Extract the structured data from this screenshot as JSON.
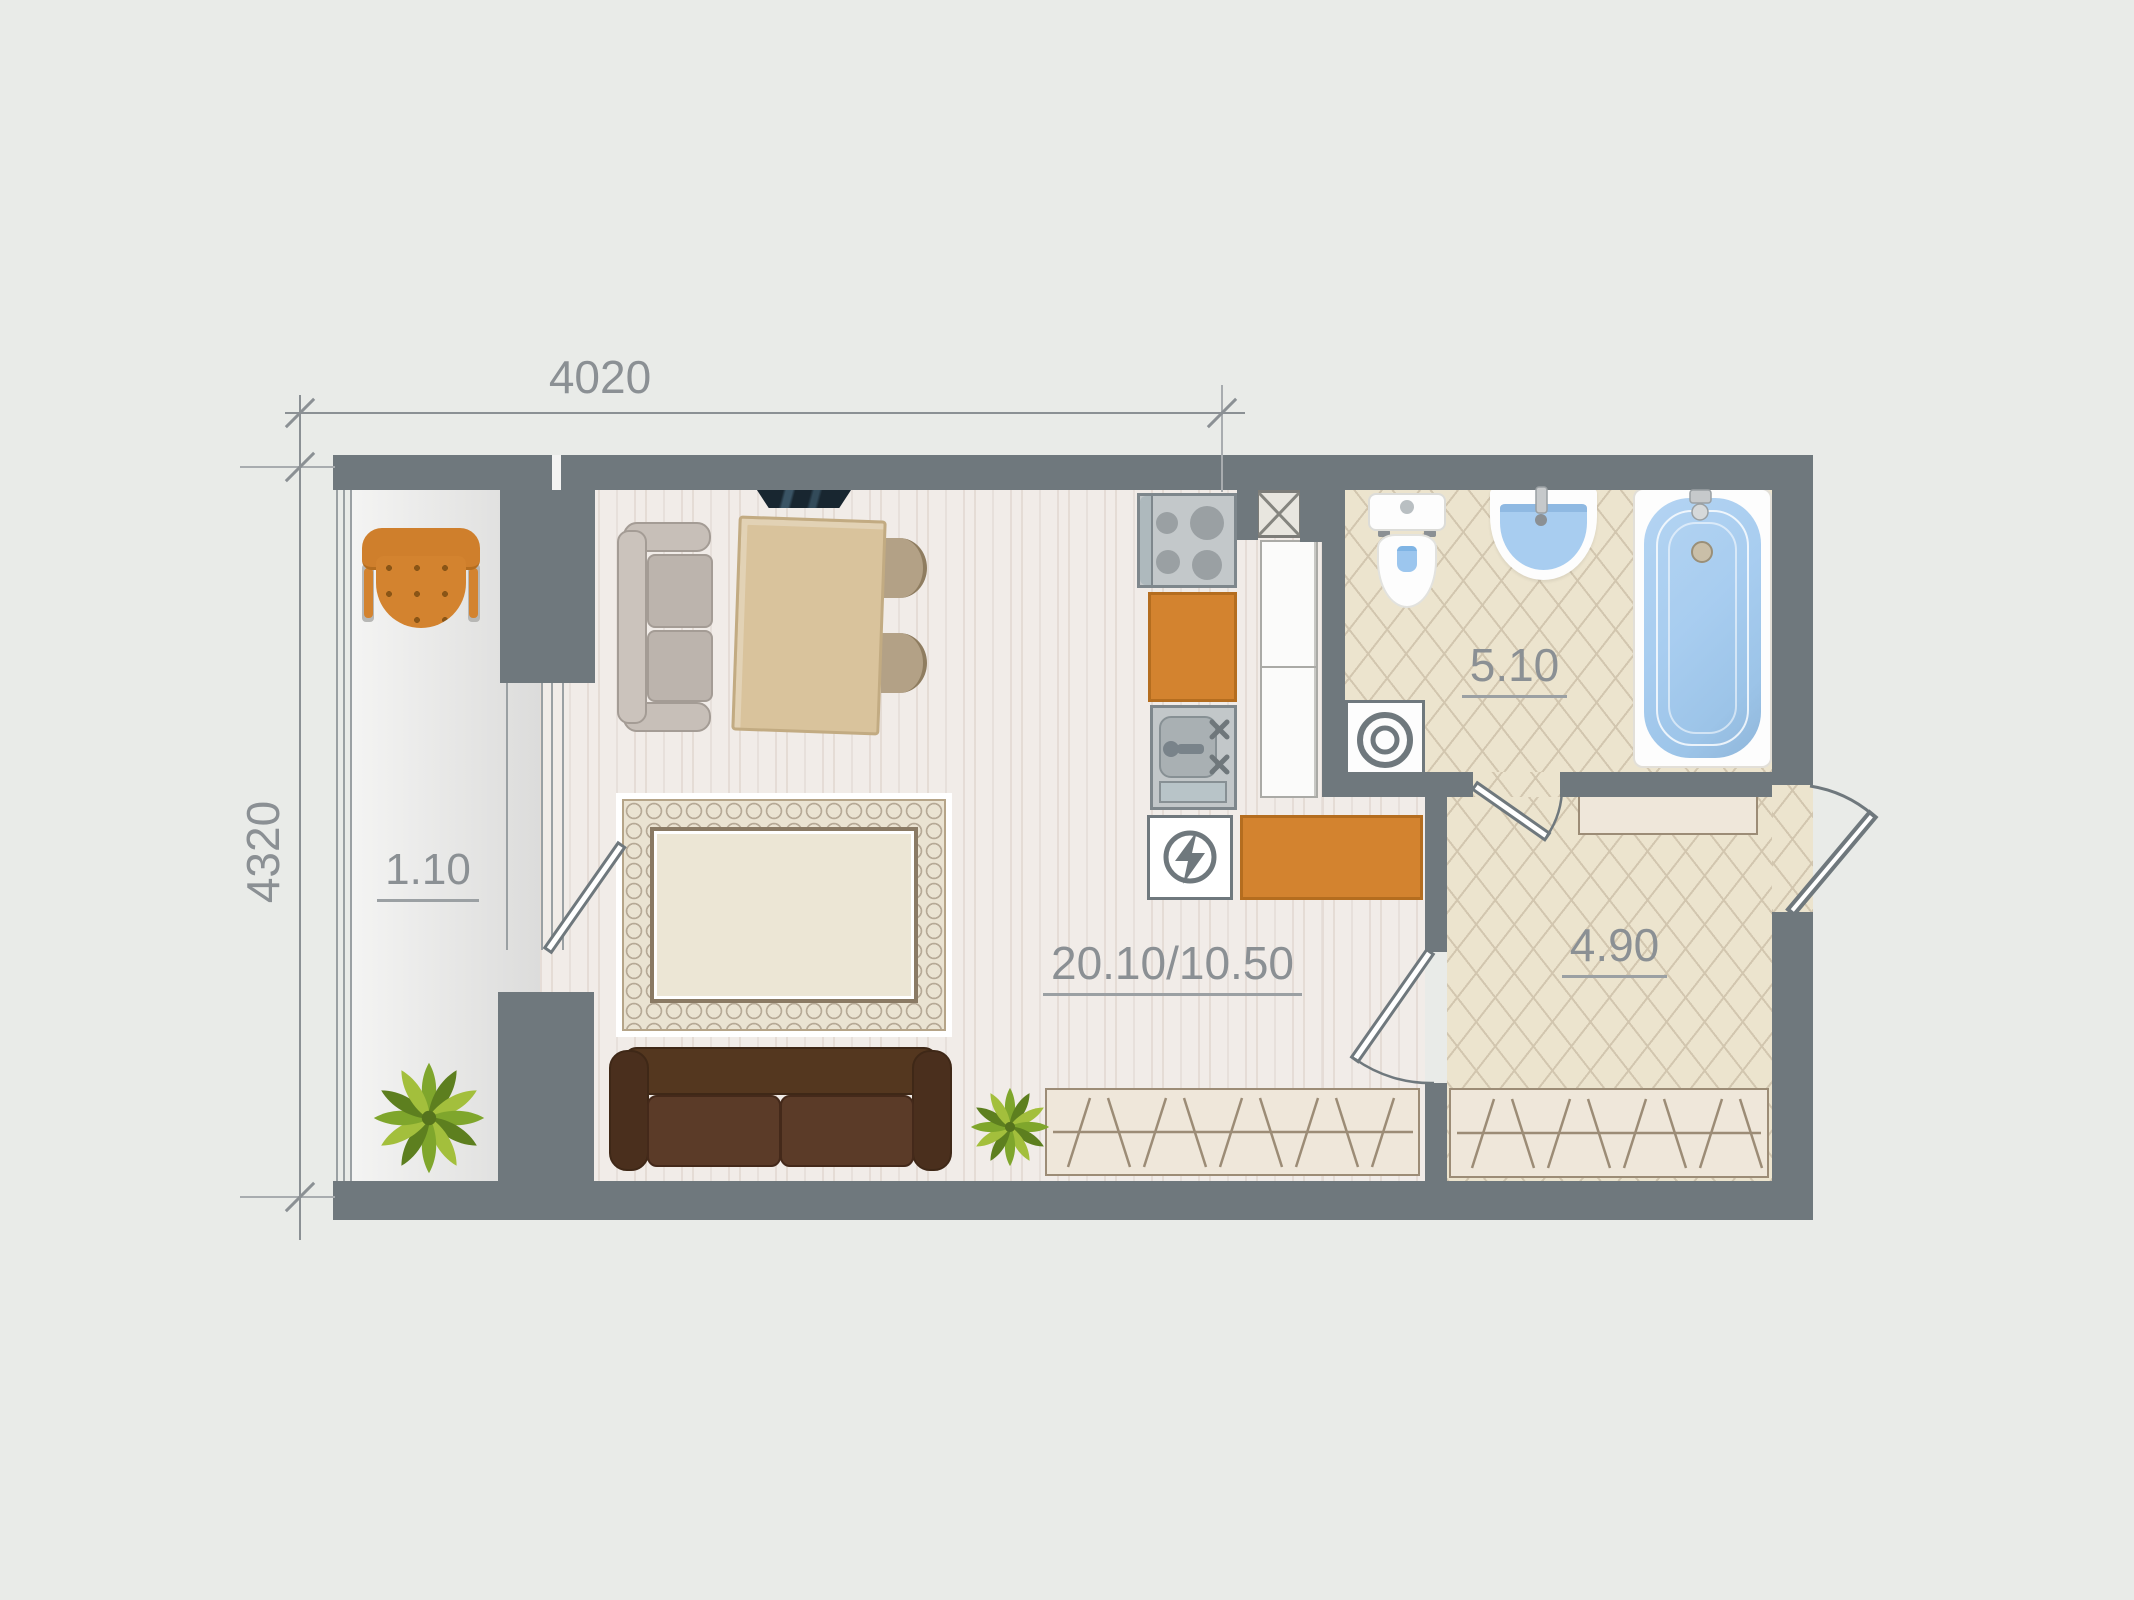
{
  "plan": {
    "dimensions": {
      "top": "4020",
      "left": "4320"
    },
    "rooms": {
      "balcony_area": "1.10",
      "living_area": "20.10/10.50",
      "bathroom_area": "5.10",
      "hallway_area": "4.90"
    },
    "furniture": [
      "armchair",
      "plant",
      "loveseat",
      "tv",
      "dining-table",
      "dining-chair",
      "rug",
      "sofa",
      "wardrobe",
      "stove",
      "kitchen-cabinet",
      "kitchen-sink",
      "electric-panel",
      "kitchen-counter",
      "vent-shaft",
      "tall-cabinet",
      "toilet",
      "washbasin",
      "bathtub",
      "washing-machine",
      "shelf"
    ]
  },
  "colors": {
    "bg": "#e9ebe8",
    "wall": "#6f787d",
    "label": "#8b9094",
    "glass": "#9aa0a3",
    "wood": "#f1ece8",
    "tile": "#ece4ce",
    "tile_line": "#d2c6af",
    "orange": "#d3832f",
    "orange_dark": "#b46d1f",
    "water": "#a8cdf0",
    "white": "#fdfdfd",
    "steel": "#c3c8ca",
    "steel_dark": "#828b90",
    "tv": "#182630",
    "green": "#7fa62c",
    "green_dark": "#5d7f1f",
    "green_light": "#a3bf3c",
    "sofa": "#5b3b28",
    "sofa_dark": "#3f2817",
    "graysofa": "#bcb4ad",
    "graysofa_dark": "#a49c95",
    "table": "#d9c39c",
    "table_border": "#c2ab82",
    "chair": "#b3a186",
    "beige": "#efe7da",
    "beige_border": "#9c8c76",
    "rug_band": "#eae3d2",
    "rug_line": "#8a7a64",
    "rug_field": "#ece6d5"
  }
}
